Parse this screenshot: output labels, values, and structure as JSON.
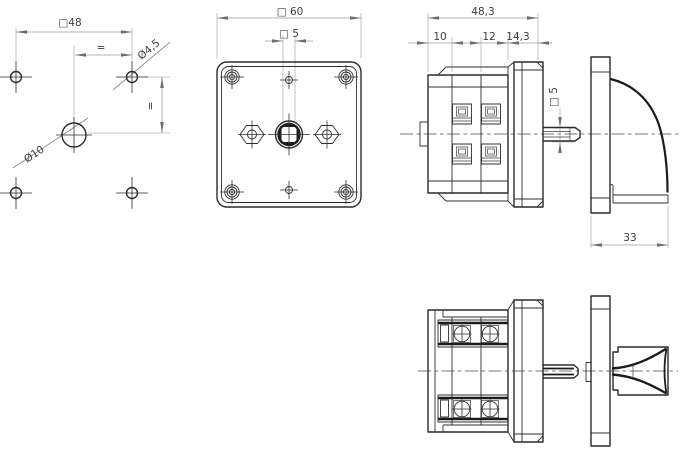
{
  "page": {
    "background": "#ffffff"
  },
  "drawing": {
    "kind": "engineering-drawing-switch",
    "colors": {
      "outline": "#2b2b2b",
      "dimension_line": "#9e9e9e",
      "extension_line": "#b5b5b5",
      "arrow": "#6e6e6e",
      "centerline": "#4a4a4a",
      "text": "#3d3d3d"
    },
    "views": {
      "drill_template": {
        "labels": {
          "square_48": "□48",
          "equal_horizontal": "=",
          "equal_vertical": "=",
          "dia_4_5": "Ø4,5",
          "dia_10": "Ø10"
        }
      },
      "front_view": {
        "labels": {
          "square_60": "□ 60",
          "square_5": "□ 5"
        }
      },
      "side_view": {
        "labels": {
          "depth_overall": "48,3",
          "depth_rear": "10",
          "depth_mid": "12",
          "depth_front": "14,3",
          "shaft_square_5": "□ 5",
          "handle_depth_33": "33"
        }
      }
    }
  }
}
